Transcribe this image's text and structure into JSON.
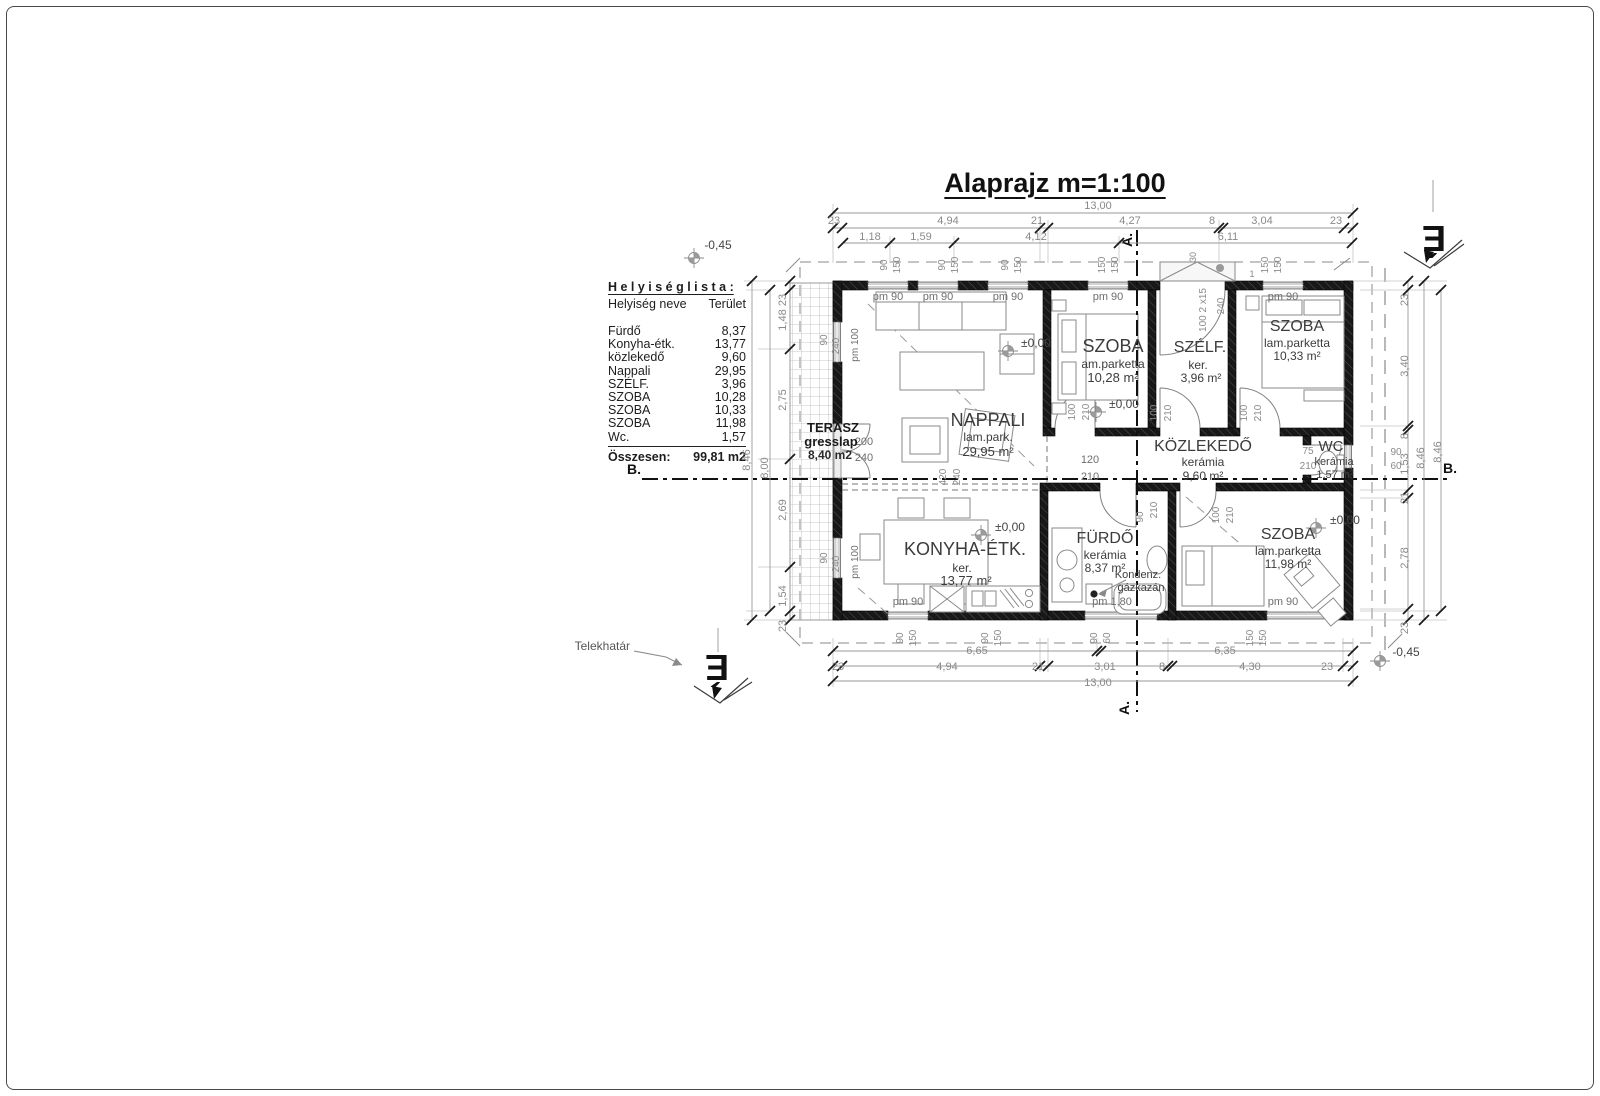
{
  "page": {
    "title": "Alaprajz  m=1:100"
  },
  "room_list": {
    "title": "H e l y i s é g  l i s t a :",
    "col_name": "Helyiség neve",
    "col_area": "Terület",
    "rows": [
      {
        "name": "Fürdő",
        "area": "8,37"
      },
      {
        "name": "Konyha-étk.",
        "area": "13,77"
      },
      {
        "name": "közlekedő",
        "area": "9,60"
      },
      {
        "name": "Nappali",
        "area": "29,95"
      },
      {
        "name": "SZÉLF.",
        "area": "3,96"
      },
      {
        "name": "SZOBA",
        "area": "10,28"
      },
      {
        "name": "SZOBA",
        "area": "10,33"
      },
      {
        "name": "SZOBA",
        "area": "11,98"
      },
      {
        "name": "Wc.",
        "area": "1,57"
      }
    ],
    "total_label": "Összesen:",
    "total_value": "99,81 m2"
  },
  "plan_texts": [
    {
      "t": "13,00",
      "x": 1098,
      "y": 209
    },
    {
      "t": "23",
      "x": 834,
      "y": 224
    },
    {
      "t": "4,94",
      "x": 948,
      "y": 224
    },
    {
      "t": "21",
      "x": 1037,
      "y": 224
    },
    {
      "t": "4,27",
      "x": 1130,
      "y": 224
    },
    {
      "t": "8",
      "x": 1212,
      "y": 224
    },
    {
      "t": "3,04",
      "x": 1262,
      "y": 224
    },
    {
      "t": "23",
      "x": 1336,
      "y": 224
    },
    {
      "t": "1,18",
      "x": 870,
      "y": 240
    },
    {
      "t": "1,59",
      "x": 921,
      "y": 240
    },
    {
      "t": "4,12",
      "x": 1036,
      "y": 240
    },
    {
      "t": "6,11",
      "x": 1228,
      "y": 240
    },
    {
      "t": "90",
      "x": 887,
      "y": 265,
      "r": -90,
      "s": 10
    },
    {
      "t": "150",
      "x": 900,
      "y": 265,
      "r": -90,
      "s": 10
    },
    {
      "t": "90",
      "x": 945,
      "y": 265,
      "r": -90,
      "s": 10
    },
    {
      "t": "150",
      "x": 958,
      "y": 265,
      "r": -90,
      "s": 10
    },
    {
      "t": "90",
      "x": 1008,
      "y": 265,
      "r": -90,
      "s": 10
    },
    {
      "t": "150",
      "x": 1021,
      "y": 265,
      "r": -90,
      "s": 10
    },
    {
      "t": "150",
      "x": 1105,
      "y": 265,
      "r": -90,
      "s": 10
    },
    {
      "t": "150",
      "x": 1118,
      "y": 265,
      "r": -90,
      "s": 10
    },
    {
      "t": "150",
      "x": 1268,
      "y": 265,
      "r": -90,
      "s": 10
    },
    {
      "t": "150",
      "x": 1281,
      "y": 265,
      "r": -90,
      "s": 10
    },
    {
      "t": "30",
      "x": 1196,
      "y": 257,
      "r": -90,
      "s": 9
    },
    {
      "t": "100 2 x15",
      "x": 1206,
      "y": 310,
      "r": -90,
      "s": 10
    },
    {
      "t": "240",
      "x": 1224,
      "y": 306,
      "r": -90,
      "s": 10
    },
    {
      "t": "1",
      "x": 1252,
      "y": 277,
      "s": 9
    },
    {
      "t": "6,65",
      "x": 977,
      "y": 654
    },
    {
      "t": "6,35",
      "x": 1225,
      "y": 654
    },
    {
      "t": "23",
      "x": 838,
      "y": 670
    },
    {
      "t": "4,94",
      "x": 947,
      "y": 670
    },
    {
      "t": "21",
      "x": 1038,
      "y": 670
    },
    {
      "t": "3,01",
      "x": 1105,
      "y": 670
    },
    {
      "t": "8",
      "x": 1162,
      "y": 670
    },
    {
      "t": "4,30",
      "x": 1250,
      "y": 670
    },
    {
      "t": "23",
      "x": 1327,
      "y": 670
    },
    {
      "t": "13,00",
      "x": 1098,
      "y": 686
    },
    {
      "t": "90",
      "x": 903,
      "y": 638,
      "r": -90,
      "s": 10
    },
    {
      "t": "150",
      "x": 916,
      "y": 638,
      "r": -90,
      "s": 10
    },
    {
      "t": "90",
      "x": 988,
      "y": 638,
      "r": -90,
      "s": 10
    },
    {
      "t": "150",
      "x": 1001,
      "y": 638,
      "r": -90,
      "s": 10
    },
    {
      "t": "90",
      "x": 1097,
      "y": 638,
      "r": -90,
      "s": 10
    },
    {
      "t": "60",
      "x": 1110,
      "y": 638,
      "r": -90,
      "s": 10
    },
    {
      "t": "150",
      "x": 1253,
      "y": 638,
      "r": -90,
      "s": 10
    },
    {
      "t": "150",
      "x": 1266,
      "y": 638,
      "r": -90,
      "s": 10
    },
    {
      "t": "23",
      "x": 786,
      "y": 300,
      "r": -90
    },
    {
      "t": "1,48",
      "x": 786,
      "y": 320,
      "r": -90
    },
    {
      "t": "2,75",
      "x": 786,
      "y": 400,
      "r": -90
    },
    {
      "t": "2,69",
      "x": 786,
      "y": 510,
      "r": -90
    },
    {
      "t": "1,54",
      "x": 786,
      "y": 596,
      "r": -90
    },
    {
      "t": "23",
      "x": 786,
      "y": 626,
      "r": -90
    },
    {
      "t": "8,00",
      "x": 768,
      "y": 468,
      "r": -90
    },
    {
      "t": "8,46",
      "x": 750,
      "y": 460,
      "r": -90
    },
    {
      "t": "23",
      "x": 1408,
      "y": 300,
      "r": -90
    },
    {
      "t": "3,40",
      "x": 1408,
      "y": 366,
      "r": -90
    },
    {
      "t": "8",
      "x": 1408,
      "y": 436,
      "r": -90
    },
    {
      "t": "1,53",
      "x": 1408,
      "y": 464,
      "r": -90
    },
    {
      "t": "21",
      "x": 1408,
      "y": 498,
      "r": -90
    },
    {
      "t": "2,78",
      "x": 1408,
      "y": 558,
      "r": -90
    },
    {
      "t": "23",
      "x": 1408,
      "y": 628,
      "r": -90
    },
    {
      "t": "8,46",
      "x": 1424,
      "y": 458,
      "r": -90
    },
    {
      "t": "8,46",
      "x": 1441,
      "y": 452,
      "r": -90
    },
    {
      "t": "90",
      "x": 1396,
      "y": 455,
      "s": 10
    },
    {
      "t": "60",
      "x": 1396,
      "y": 469,
      "s": 10
    },
    {
      "t": "pm 90",
      "x": 888,
      "y": 300,
      "c": "#6e6e6e"
    },
    {
      "t": "pm 90",
      "x": 938,
      "y": 300,
      "c": "#6e6e6e"
    },
    {
      "t": "pm 90",
      "x": 1008,
      "y": 300,
      "c": "#6e6e6e"
    },
    {
      "t": "pm 90",
      "x": 1108,
      "y": 300,
      "c": "#6e6e6e"
    },
    {
      "t": "pm 90",
      "x": 1283,
      "y": 300,
      "c": "#6e6e6e"
    },
    {
      "t": "pm 90",
      "x": 908,
      "y": 605,
      "c": "#6e6e6e"
    },
    {
      "t": "pm 1,80",
      "x": 1112,
      "y": 605,
      "c": "#6e6e6e"
    },
    {
      "t": "pm 90",
      "x": 1283,
      "y": 605,
      "c": "#6e6e6e"
    },
    {
      "t": "90",
      "x": 827,
      "y": 340,
      "r": -90,
      "s": 10
    },
    {
      "t": "240",
      "x": 839,
      "y": 346,
      "r": -90,
      "s": 10
    },
    {
      "t": "pm 100",
      "x": 858,
      "y": 345,
      "r": -90,
      "s": 10,
      "c": "#6e6e6e"
    },
    {
      "t": "90",
      "x": 827,
      "y": 558,
      "r": -90,
      "s": 10
    },
    {
      "t": "240",
      "x": 839,
      "y": 564,
      "r": -90,
      "s": 10
    },
    {
      "t": "pm 100",
      "x": 858,
      "y": 562,
      "r": -90,
      "s": 10,
      "c": "#6e6e6e"
    },
    {
      "t": "200",
      "x": 864,
      "y": 445,
      "c": "#6e6e6e"
    },
    {
      "t": "240",
      "x": 864,
      "y": 461,
      "c": "#6e6e6e"
    },
    {
      "t": "120",
      "x": 1090,
      "y": 463,
      "c": "#6e6e6e"
    },
    {
      "t": "210",
      "x": 1090,
      "y": 480,
      "c": "#6e6e6e"
    },
    {
      "t": "420",
      "x": 946,
      "y": 477,
      "r": -90,
      "s": 10
    },
    {
      "t": "240",
      "x": 960,
      "y": 477,
      "r": -90,
      "s": 10
    },
    {
      "t": "100",
      "x": 1075,
      "y": 412,
      "r": -90,
      "s": 10
    },
    {
      "t": "210",
      "x": 1089,
      "y": 412,
      "r": -90,
      "s": 10
    },
    {
      "t": "100",
      "x": 1157,
      "y": 413,
      "r": -90,
      "s": 10
    },
    {
      "t": "210",
      "x": 1171,
      "y": 413,
      "r": -90,
      "s": 10
    },
    {
      "t": "100",
      "x": 1247,
      "y": 413,
      "r": -90,
      "s": 10
    },
    {
      "t": "210",
      "x": 1261,
      "y": 413,
      "r": -90,
      "s": 10
    },
    {
      "t": "75",
      "x": 1308,
      "y": 454,
      "s": 10
    },
    {
      "t": "210",
      "x": 1308,
      "y": 469,
      "s": 10
    },
    {
      "t": "90",
      "x": 1143,
      "y": 517,
      "r": -90,
      "s": 10
    },
    {
      "t": "210",
      "x": 1157,
      "y": 510,
      "r": -90,
      "s": 10
    },
    {
      "t": "100",
      "x": 1219,
      "y": 515,
      "r": -90,
      "s": 10
    },
    {
      "t": "210",
      "x": 1233,
      "y": 515,
      "r": -90,
      "s": 10
    },
    {
      "t": "±0,00",
      "x": 1036,
      "y": 347,
      "s": 12,
      "c": "#444444"
    },
    {
      "t": "±0,00",
      "x": 1124,
      "y": 408,
      "s": 12,
      "c": "#444444"
    },
    {
      "t": "±0,00",
      "x": 1010,
      "y": 531,
      "s": 12,
      "c": "#444444"
    },
    {
      "t": "±0,00",
      "x": 1345,
      "y": 524,
      "s": 12,
      "c": "#444444"
    },
    {
      "t": "-0,45",
      "x": 718,
      "y": 249,
      "s": 12,
      "c": "#444444"
    },
    {
      "t": "-0,45",
      "x": 1406,
      "y": 656,
      "s": 12,
      "c": "#444444"
    },
    {
      "t": "A.",
      "x": 1132,
      "y": 240,
      "r": -90,
      "s": 14,
      "w": 600,
      "c": "#111111"
    },
    {
      "t": "A.",
      "x": 1129,
      "y": 708,
      "r": -90,
      "s": 14,
      "w": 600,
      "c": "#111111"
    },
    {
      "t": "B.",
      "x": 634,
      "y": 474,
      "s": 14,
      "w": 600,
      "c": "#111111"
    },
    {
      "t": "B.",
      "x": 1450,
      "y": 473,
      "s": 14,
      "w": 600,
      "c": "#111111"
    },
    {
      "t": "NAPPALI",
      "x": 988,
      "y": 426,
      "s": 18,
      "c": "#3c3c3c"
    },
    {
      "t": "lam.park.",
      "x": 988,
      "y": 441,
      "s": 12,
      "c": "#3c3c3c"
    },
    {
      "t": "29,95 m²",
      "x": 988,
      "y": 456,
      "s": 13,
      "c": "#3c3c3c"
    },
    {
      "t": "SZOBA",
      "x": 1113,
      "y": 352,
      "s": 18,
      "c": "#3c3c3c"
    },
    {
      "t": "am.parketta",
      "x": 1113,
      "y": 368,
      "s": 12,
      "c": "#3c3c3c"
    },
    {
      "t": "10,28 m²",
      "x": 1113,
      "y": 382,
      "s": 13,
      "c": "#3c3c3c"
    },
    {
      "t": "SZÉLF.",
      "x": 1200,
      "y": 352,
      "s": 16,
      "c": "#3c3c3c"
    },
    {
      "t": "ker.",
      "x": 1198,
      "y": 369,
      "s": 12,
      "c": "#3c3c3c"
    },
    {
      "t": "3,96 m²",
      "x": 1201,
      "y": 382,
      "s": 12,
      "c": "#3c3c3c"
    },
    {
      "t": "SZOBA",
      "x": 1297,
      "y": 331,
      "s": 16,
      "c": "#3c3c3c"
    },
    {
      "t": "lam.parketta",
      "x": 1297,
      "y": 347,
      "s": 12,
      "c": "#3c3c3c"
    },
    {
      "t": "10,33 m²",
      "x": 1297,
      "y": 360,
      "s": 12,
      "c": "#3c3c3c"
    },
    {
      "t": "KÖZLEKEDŐ",
      "x": 1203,
      "y": 451,
      "s": 16,
      "c": "#3c3c3c"
    },
    {
      "t": "kerámia",
      "x": 1203,
      "y": 466,
      "s": 12,
      "c": "#3c3c3c"
    },
    {
      "t": "9,60 m²",
      "x": 1203,
      "y": 480,
      "s": 12,
      "c": "#3c3c3c"
    },
    {
      "t": "WC",
      "x": 1331,
      "y": 451,
      "s": 15,
      "c": "#3c3c3c"
    },
    {
      "t": "kerámia",
      "x": 1334,
      "y": 465,
      "s": 11,
      "c": "#3c3c3c"
    },
    {
      "t": "1,57 m²",
      "x": 1335,
      "y": 478,
      "s": 11,
      "c": "#3c3c3c"
    },
    {
      "t": "KONYHA-ÉTK.",
      "x": 965,
      "y": 555,
      "s": 18,
      "c": "#3c3c3c"
    },
    {
      "t": "ker.",
      "x": 962,
      "y": 572,
      "s": 12,
      "c": "#3c3c3c"
    },
    {
      "t": "13,77 m²",
      "x": 966,
      "y": 585,
      "s": 13,
      "c": "#3c3c3c"
    },
    {
      "t": "FÜRDŐ",
      "x": 1105,
      "y": 543,
      "s": 16,
      "c": "#3c3c3c"
    },
    {
      "t": "kerámia",
      "x": 1105,
      "y": 559,
      "s": 12,
      "c": "#3c3c3c"
    },
    {
      "t": "8,37 m²",
      "x": 1105,
      "y": 572,
      "s": 12,
      "c": "#3c3c3c"
    },
    {
      "t": "Kondenz.",
      "x": 1138,
      "y": 578,
      "s": 11,
      "c": "#3c3c3c"
    },
    {
      "t": "gázkazán",
      "x": 1141,
      "y": 591,
      "s": 11,
      "c": "#3c3c3c"
    },
    {
      "t": "SZOBA",
      "x": 1288,
      "y": 539,
      "s": 16,
      "c": "#3c3c3c"
    },
    {
      "t": "lam.parketta",
      "x": 1288,
      "y": 555,
      "s": 12,
      "c": "#3c3c3c"
    },
    {
      "t": "11,98 m²",
      "x": 1288,
      "y": 568,
      "s": 12,
      "c": "#3c3c3c"
    },
    {
      "t": "TERASZ",
      "x": 833,
      "y": 432,
      "s": 13,
      "w": 700,
      "c": "#1a1a1a"
    },
    {
      "t": "gresslap",
      "x": 831,
      "y": 446,
      "s": 13,
      "w": 700,
      "c": "#1a1a1a"
    },
    {
      "t": "8,40 m2",
      "x": 830,
      "y": 459,
      "s": 12,
      "w": 600,
      "c": "#2a2a2a"
    },
    {
      "t": "Telekhatár",
      "x": 630,
      "y": 650,
      "s": 12,
      "a": "e",
      "c": "#555555"
    },
    {
      "t": "É",
      "x": 1434,
      "y": 226,
      "r": 180,
      "s": 36,
      "w": 700,
      "c": "#111111"
    },
    {
      "t": "É",
      "x": 717,
      "y": 655,
      "r": 180,
      "s": 36,
      "w": 700,
      "c": "#111111"
    }
  ],
  "dim_lines": [
    [
      833,
      213,
      1353,
      213
    ],
    [
      833,
      228,
      1353,
      228
    ],
    [
      843,
      243,
      1352,
      243
    ],
    [
      833,
      651,
      1353,
      651
    ],
    [
      833,
      666,
      1353,
      666
    ],
    [
      833,
      681,
      1353,
      681
    ],
    [
      752,
      281,
      752,
      620
    ],
    [
      770,
      290,
      770,
      611
    ],
    [
      790,
      281,
      790,
      620
    ],
    [
      1408,
      281,
      1408,
      620
    ],
    [
      1424,
      281,
      1424,
      620
    ],
    [
      1441,
      290,
      1441,
      611
    ]
  ],
  "thin_lines": [
    [
      833,
      204,
      833,
      263
    ],
    [
      1353,
      204,
      1353,
      263
    ],
    [
      1040,
      220,
      1040,
      263
    ],
    [
      1048,
      220,
      1048,
      263
    ],
    [
      1219,
      220,
      1219,
      263
    ],
    [
      890,
      236,
      890,
      263
    ],
    [
      954,
      236,
      954,
      263
    ],
    [
      1119,
      236,
      1119,
      263
    ],
    [
      833,
      638,
      833,
      687
    ],
    [
      1353,
      638,
      1353,
      687
    ],
    [
      1040,
      638,
      1040,
      672
    ],
    [
      1048,
      638,
      1048,
      672
    ],
    [
      1168,
      638,
      1168,
      672
    ],
    [
      1343,
      638,
      1343,
      672
    ],
    [
      1097,
      638,
      1097,
      657
    ],
    [
      744,
      281,
      790,
      281
    ],
    [
      744,
      620,
      790,
      620
    ],
    [
      746,
      290,
      770,
      290
    ],
    [
      746,
      611,
      770,
      611
    ],
    [
      758,
      349,
      790,
      349
    ],
    [
      758,
      459,
      790,
      459
    ],
    [
      758,
      567,
      790,
      567
    ],
    [
      1353,
      281,
      1447,
      281
    ],
    [
      1353,
      620,
      1447,
      620
    ],
    [
      1360,
      290,
      1441,
      290
    ],
    [
      1360,
      611,
      1441,
      611
    ],
    [
      1360,
      426,
      1408,
      426
    ],
    [
      1360,
      490,
      1408,
      490
    ],
    [
      1360,
      498,
      1408,
      498
    ],
    [
      1360,
      609,
      1408,
      609
    ]
  ],
  "ticks": [
    [
      833,
      213
    ],
    [
      1353,
      213
    ],
    [
      833,
      228
    ],
    [
      842,
      228
    ],
    [
      1040,
      228
    ],
    [
      1048,
      228
    ],
    [
      1219,
      228
    ],
    [
      1223,
      228
    ],
    [
      1344,
      228
    ],
    [
      1353,
      228
    ],
    [
      843,
      243
    ],
    [
      890,
      243
    ],
    [
      954,
      243
    ],
    [
      1119,
      243
    ],
    [
      1352,
      243
    ],
    [
      833,
      651
    ],
    [
      1097,
      651
    ],
    [
      1101,
      651
    ],
    [
      1353,
      651
    ],
    [
      833,
      666
    ],
    [
      842,
      666
    ],
    [
      1040,
      666
    ],
    [
      1048,
      666
    ],
    [
      1168,
      666
    ],
    [
      1172,
      666
    ],
    [
      1343,
      666
    ],
    [
      1353,
      666
    ],
    [
      833,
      681
    ],
    [
      1353,
      681
    ],
    [
      752,
      281
    ],
    [
      752,
      620
    ],
    [
      770,
      290
    ],
    [
      770,
      611
    ],
    [
      790,
      281
    ],
    [
      790,
      290
    ],
    [
      790,
      349
    ],
    [
      790,
      459
    ],
    [
      790,
      567
    ],
    [
      790,
      611
    ],
    [
      790,
      620
    ],
    [
      1408,
      281
    ],
    [
      1408,
      290
    ],
    [
      1408,
      426
    ],
    [
      1408,
      430
    ],
    [
      1408,
      490
    ],
    [
      1408,
      498
    ],
    [
      1408,
      609
    ],
    [
      1408,
      620
    ],
    [
      1424,
      281
    ],
    [
      1424,
      620
    ],
    [
      1441,
      290
    ],
    [
      1441,
      611
    ]
  ]
}
